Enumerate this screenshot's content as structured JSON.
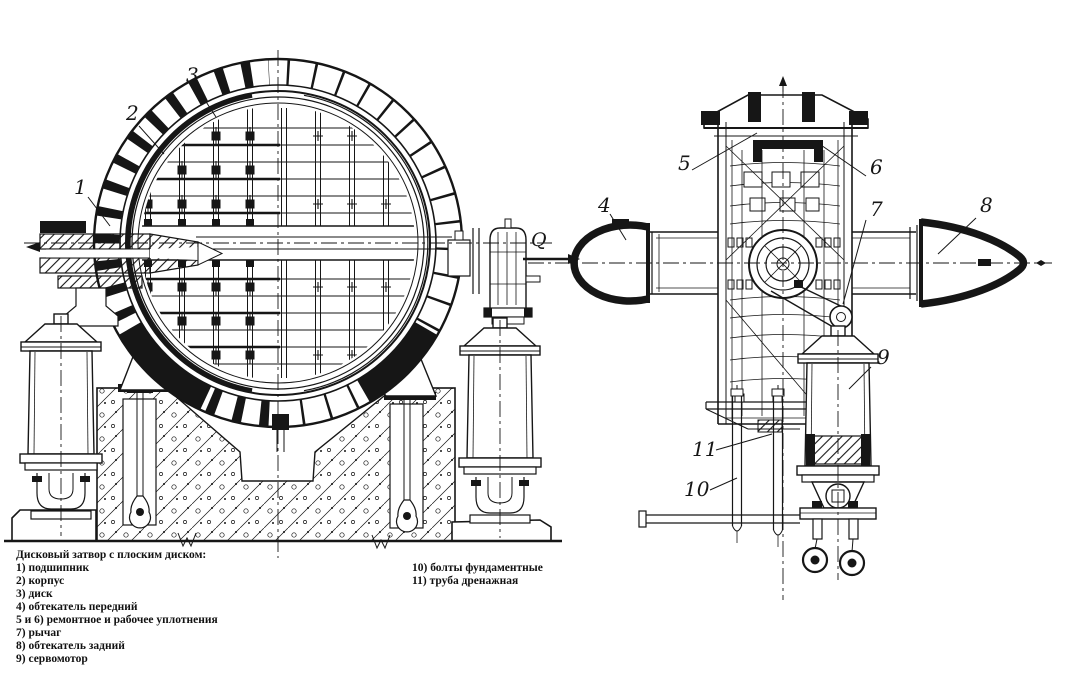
{
  "colors": {
    "ink": "#161616",
    "paper": "#ffffff"
  },
  "legend": {
    "title": "Дисковый затвор с плоским диском:",
    "col1": [
      "1) подшипник",
      "2) корпус",
      "3) диск",
      "4) обтекатель передний",
      "5 и 6) ремонтное и рабочее уплотнения",
      "7) рычаг",
      "8) обтекатель задний",
      "9) сервомотор"
    ],
    "col2": [
      "10) болты фундаментные",
      "11) труба дренажная"
    ]
  },
  "drawing": {
    "flow_label": "Q",
    "callouts": {
      "n1": "1",
      "n2": "2",
      "n3": "3",
      "n4": "4",
      "n5": "5",
      "n6": "6",
      "n7": "7",
      "n8": "8",
      "n9": "9",
      "n10": "10",
      "n11": "11"
    }
  }
}
